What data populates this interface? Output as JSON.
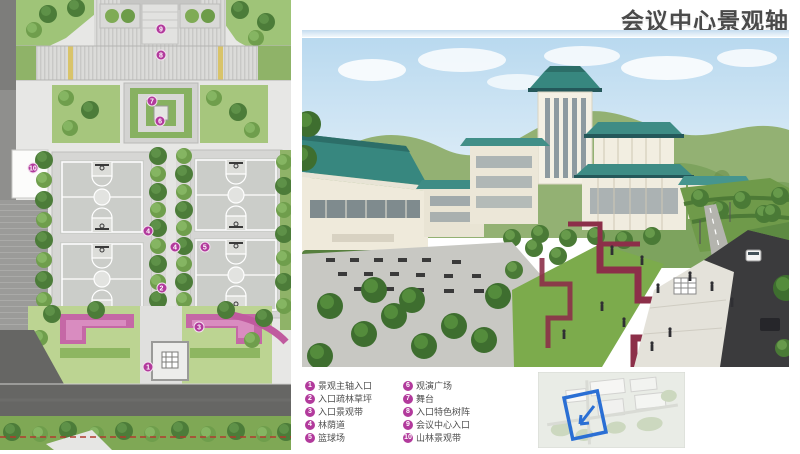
{
  "page": {
    "title": "会议中心景观轴",
    "title_color": "#4a4a4a",
    "accent_band_color": "#c5dcef"
  },
  "legend": {
    "badge_color": "#b23a9c",
    "items": [
      {
        "num": "1",
        "label": "景观主轴入口"
      },
      {
        "num": "2",
        "label": "入口疏林草坪"
      },
      {
        "num": "3",
        "label": "入口景观带"
      },
      {
        "num": "4",
        "label": "林荫道"
      },
      {
        "num": "5",
        "label": "篮球场"
      },
      {
        "num": "6",
        "label": "观演广场"
      },
      {
        "num": "7",
        "label": "舞台"
      },
      {
        "num": "8",
        "label": "入口特色树阵"
      },
      {
        "num": "9",
        "label": "会议中心入口"
      },
      {
        "num": "10",
        "label": "山林景观带"
      }
    ]
  },
  "plan": {
    "badges": [
      {
        "num": "9",
        "x": 55.3,
        "y": 6.4
      },
      {
        "num": "8",
        "x": 55.3,
        "y": 12.2
      },
      {
        "num": "7",
        "x": 52.2,
        "y": 22.4
      },
      {
        "num": "6",
        "x": 55.0,
        "y": 26.9
      },
      {
        "num": "10",
        "x": 11.3,
        "y": 37.3
      },
      {
        "num": "4",
        "x": 50.9,
        "y": 51.3
      },
      {
        "num": "4",
        "x": 60.1,
        "y": 54.9
      },
      {
        "num": "5",
        "x": 70.4,
        "y": 54.9
      },
      {
        "num": "2",
        "x": 55.5,
        "y": 64.1
      },
      {
        "num": "3",
        "x": 68.4,
        "y": 72.7
      },
      {
        "num": "1",
        "x": 50.9,
        "y": 81.6
      }
    ]
  },
  "locator": {
    "highlight_color": "#2a6fd4"
  }
}
